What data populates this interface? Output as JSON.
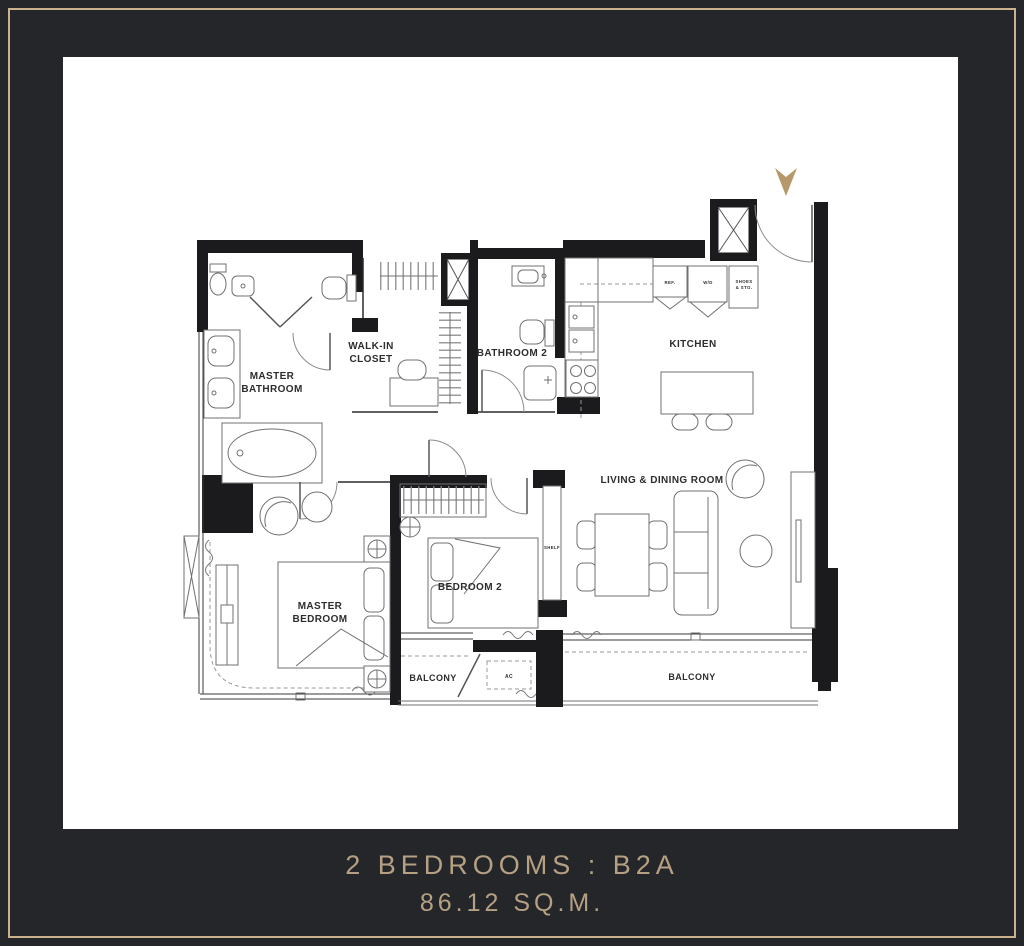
{
  "page": {
    "background_color": "#242629",
    "frame_color": "#c9b28c",
    "card_color": "#ffffff",
    "accent_color": "#b6986a",
    "wall_color": "#1b1b1d"
  },
  "caption": {
    "line1": "2 BEDROOMS : B2A",
    "line2": "86.12 SQ.M.",
    "color": "#b5a083"
  },
  "plan": {
    "labels": {
      "master_bathroom_1": "MASTER",
      "master_bathroom_2": "BATHROOM",
      "walk_in_closet_1": "WALK-IN",
      "walk_in_closet_2": "CLOSET",
      "bathroom2": "BATHROOM 2",
      "kitchen": "KITCHEN",
      "living_dining": "LIVING & DINING ROOM",
      "master_bedroom_1": "MASTER",
      "master_bedroom_2": "BEDROOM",
      "bedroom2": "BEDROOM 2",
      "balcony_left": "BALCONY",
      "balcony_right": "BALCONY",
      "shelf": "SHELF",
      "ac": "AC",
      "ref": "REF.",
      "wd": "W/D",
      "shoes_1": "SHOES",
      "shoes_2": "& STO."
    }
  }
}
